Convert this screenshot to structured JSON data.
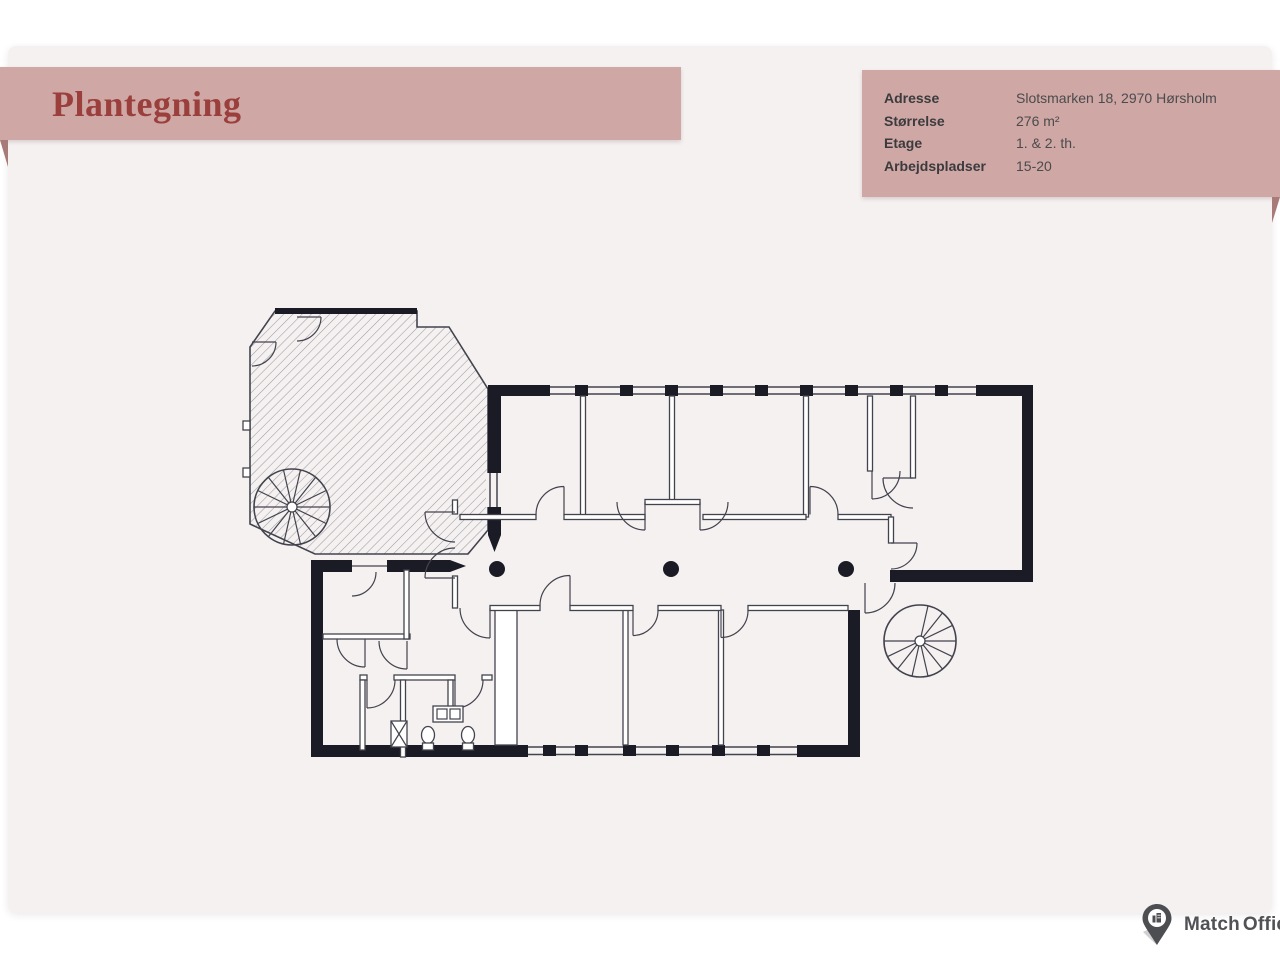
{
  "page": {
    "title": "Plantegning"
  },
  "info": {
    "rows": [
      {
        "label": "Adresse",
        "value": "Slotsmarken 18, 2970 Hørsholm"
      },
      {
        "label": "Størrelse",
        "value": "276 m²"
      },
      {
        "label": "Etage",
        "value": "1. & 2. th."
      },
      {
        "label": "Arbejdspladser",
        "value": "15-20"
      }
    ]
  },
  "branding": {
    "name_part1": "Match",
    "name_part2": "Office"
  },
  "colors": {
    "banner_pink": "#cfa7a5",
    "banner_fold": "#a87a78",
    "title_red": "#9a3f3b",
    "sheet_bg": "#f5f1f1",
    "page_bg": "#ffffff",
    "label_dark": "#3b3b3d",
    "value_dark": "#4b4b4d",
    "wall_dark": "#1b1b26",
    "line_gray": "#43434d",
    "hatch_gray": "#9b9ba3",
    "logo_gray": "#515256"
  }
}
